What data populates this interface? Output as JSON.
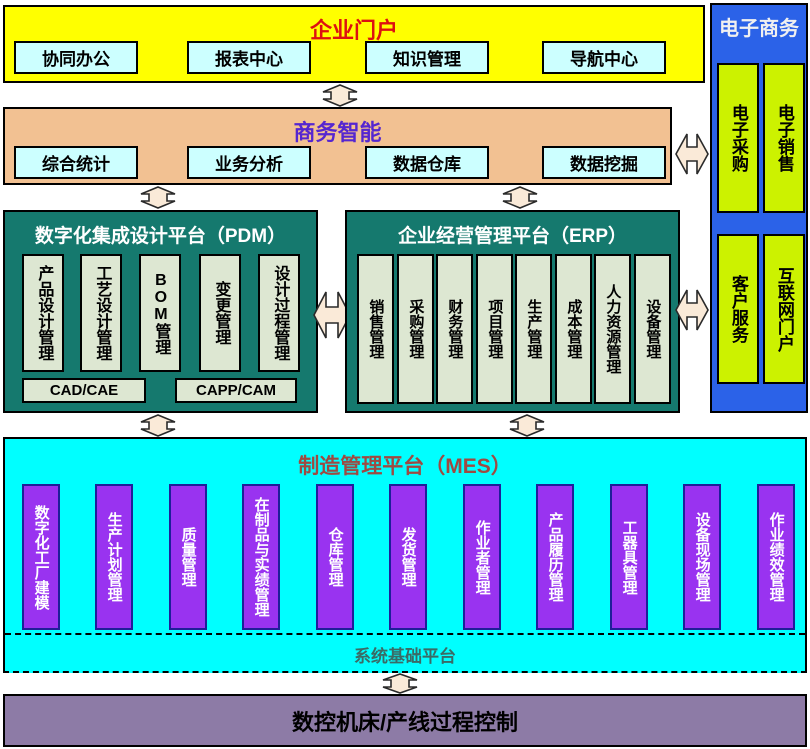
{
  "portal": {
    "title": "企业门户",
    "items": [
      "协同办公",
      "报表中心",
      "知识管理",
      "导航中心"
    ]
  },
  "bi": {
    "title": "商务智能",
    "items": [
      "综合统计",
      "业务分析",
      "数据仓库",
      "数据挖掘"
    ]
  },
  "pdm": {
    "title": "数字化集成设计平台（PDM）",
    "columns": [
      "产品设计管理",
      "工艺设计管理",
      "BOM管理",
      "变更管理",
      "设计过程管理"
    ],
    "footers": [
      "CAD/CAE",
      "CAPP/CAM"
    ]
  },
  "erp": {
    "title": "企业经营管理平台（ERP）",
    "columns": [
      "销售管理",
      "采购管理",
      "财务管理",
      "项目管理",
      "生产管理",
      "成本管理",
      "人力资源管理",
      "设备管理"
    ]
  },
  "ecommerce": {
    "title": "电子商务",
    "items": [
      "电子采购",
      "电子销售",
      "客户服务",
      "互联网门户"
    ]
  },
  "mes": {
    "title": "制造管理平台（MES）",
    "columns": [
      "数字化工厂建模",
      "生产计划管理",
      "质量管理",
      "在制品与实绩管理",
      "仓库管理",
      "发货管理",
      "作业者管理",
      "产品履历管理",
      "工器具管理",
      "设备现场管理",
      "作业绩效管理"
    ],
    "foundation": "系统基础平台"
  },
  "control": {
    "title": "数控机床/产线过程控制"
  },
  "colors": {
    "portal_bg": "#ffff00",
    "portal_title": "#dd1111",
    "chip_bg": "#ccffff",
    "bi_bg": "#f2c192",
    "bi_title": "#5526d0",
    "platform_bg": "#15796e",
    "platform_column_bg": "#dde7d2",
    "ecommerce_bg": "#2b62e8",
    "ecommerce_item_bg": "#ccf200",
    "mes_bg": "#00ffff",
    "mes_title": "#9e4a42",
    "mes_column_bg": "#9933f0",
    "mes_column_border": "#1f1f99",
    "foundation_text": "#3a6b66",
    "control_bg": "#8d7ba6",
    "arrow_fill": "#faead8"
  }
}
